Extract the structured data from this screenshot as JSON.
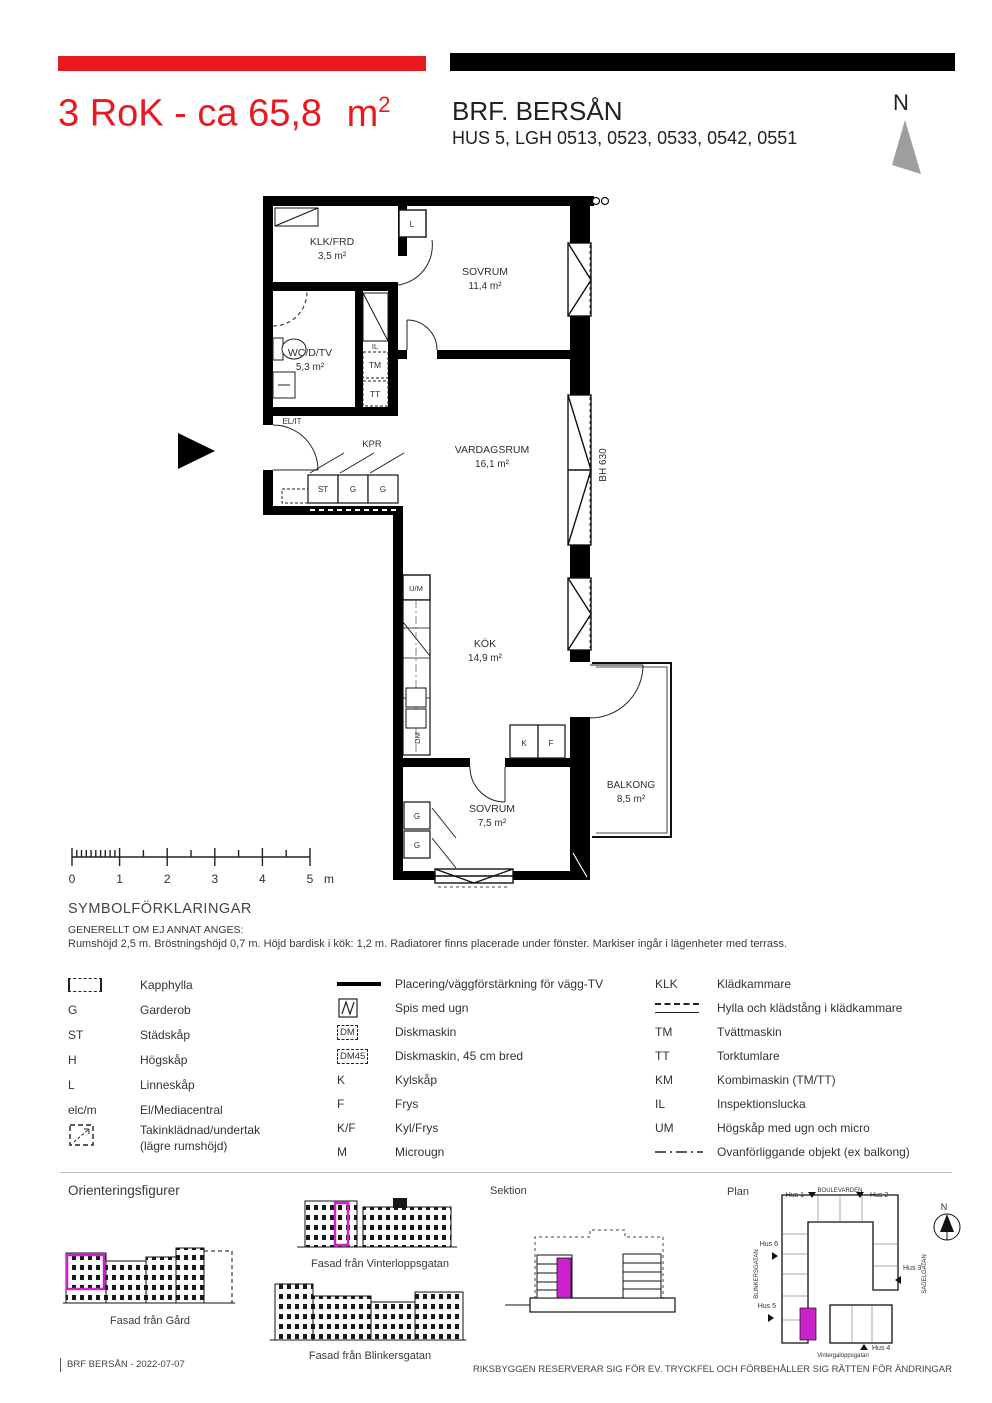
{
  "header": {
    "title_main": "3 RoK - ca 65,8",
    "title_unit": "m",
    "title_sup": "2",
    "project_name": "BRF. BERSÅN",
    "project_sub": "HUS 5, LGH 0513, 0523, 0533, 0542, 0551",
    "north_label": "N"
  },
  "colors": {
    "accent_red": "#e8191f",
    "highlight_magenta": "#cc22cc",
    "north_gray": "#9e9e9e"
  },
  "floorplan": {
    "rooms": {
      "klk": {
        "name": "KLK/FRD",
        "area": "3,5 m²"
      },
      "sovrum1": {
        "name": "SOVRUM",
        "area": "11,4 m²"
      },
      "wc": {
        "name": "WC/D/TV",
        "area": "5,3 m²"
      },
      "vardagsrum": {
        "name": "VARDAGSRUM",
        "area": "16,1 m²"
      },
      "kok": {
        "name": "KÖK",
        "area": "14,9 m²"
      },
      "sovrum2": {
        "name": "SOVRUM",
        "area": "7,5 m²"
      },
      "balkong": {
        "name": "BALKONG",
        "area": "8,5 m²"
      }
    },
    "small_labels": {
      "l": "L",
      "il": "IL",
      "tm": "TM",
      "tt": "TT",
      "elit": "EL/IT",
      "kpr": "KPR",
      "st": "ST",
      "g1": "G",
      "g2": "G",
      "um": "U/M",
      "dm": "DM",
      "k": "K",
      "f": "F",
      "g3": "G",
      "g4": "G",
      "bh": "BH 630"
    },
    "scale": {
      "ticks": [
        "0",
        "1",
        "2",
        "3",
        "4",
        "5"
      ],
      "unit": "m"
    }
  },
  "legend": {
    "heading": "SYMBOLFÖRKLARINGAR",
    "subheading": "GENERELLT OM EJ ANNAT ANGES:",
    "note": "Rumshöjd 2,5 m. Bröstningshöjd 0,7 m. Höjd bardisk i kök: 1,2 m. Radiatorer finns placerade under fönster. Markiser ingår i lägenheter med terrass.",
    "col1": [
      {
        "sym": "",
        "type": "kapphylla",
        "label": "Kapphylla"
      },
      {
        "sym": "G",
        "type": "text",
        "label": "Garderob"
      },
      {
        "sym": "ST",
        "type": "text",
        "label": "Städskåp"
      },
      {
        "sym": "H",
        "type": "text",
        "label": "Högskåp"
      },
      {
        "sym": "L",
        "type": "text",
        "label": "Linneskåp"
      },
      {
        "sym": "elc/m",
        "type": "text",
        "label": "El/Mediacentral"
      },
      {
        "sym": "",
        "type": "takinkladnad",
        "label1": "Takinklädnad/undertak",
        "label2": "(lägre rumshöjd)"
      }
    ],
    "col2": [
      {
        "sym": "",
        "type": "tvline",
        "label": "Placering/väggförstärkning för vägg-TV"
      },
      {
        "sym": "",
        "type": "spis",
        "label": "Spis med ugn"
      },
      {
        "sym": "DM",
        "type": "dmbox",
        "label": "Diskmaskin"
      },
      {
        "sym": "DM45",
        "type": "dmbox",
        "label": "Diskmaskin, 45 cm bred"
      },
      {
        "sym": "K",
        "type": "text",
        "label": "Kylskåp"
      },
      {
        "sym": "F",
        "type": "text",
        "label": "Frys"
      },
      {
        "sym": "K/F",
        "type": "text",
        "label": "Kyl/Frys"
      },
      {
        "sym": "M",
        "type": "text",
        "label": "Microugn"
      }
    ],
    "col3": [
      {
        "sym": "KLK",
        "type": "text",
        "label": "Klädkammare"
      },
      {
        "sym": "",
        "type": "hylla",
        "label": "Hylla och klädstång i klädkammare"
      },
      {
        "sym": "TM",
        "type": "text",
        "label": "Tvättmaskin"
      },
      {
        "sym": "TT",
        "type": "text",
        "label": "Torktumlare"
      },
      {
        "sym": "KM",
        "type": "text",
        "label": "Kombimaskin (TM/TT)"
      },
      {
        "sym": "IL",
        "type": "text",
        "label": "Inspektionslucka"
      },
      {
        "sym": "UM",
        "type": "text",
        "label": "Högskåp med ugn och micro"
      },
      {
        "sym": "",
        "type": "dashdot",
        "label": "Ovanförliggande objekt (ex  balkong)"
      }
    ]
  },
  "orientation": {
    "heading": "Orienteringsfigurer",
    "fasad_gard": "Fasad från Gård",
    "fasad_vinterloppsgatan": "Fasad från Vinterloppsgatan",
    "fasad_blinkersgatan": "Fasad från Blinkersgatan",
    "sektion_label": "Sektion",
    "plan_label": "Plan",
    "street_top": "BOULEVARDEN",
    "street_left": "BLINKERSGATAN",
    "street_right": "SADELGATAN",
    "street_bottom": "Vintergaloppsgatan",
    "hus1": "Hus 1",
    "hus2": "Hus 2",
    "hus3": "Hus 3",
    "hus4": "Hus 4",
    "hus5": "Hus 5",
    "hus6": "Hus 6",
    "north_label": "N"
  },
  "footer": {
    "left": "BRF BERSÅN - 2022-07-07",
    "right": "RIKSBYGGEN RESERVERAR SIG FÖR EV. TRYCKFEL OCH FÖRBEHÅLLER SIG RÄTTEN FÖR ÄNDRINGAR"
  }
}
